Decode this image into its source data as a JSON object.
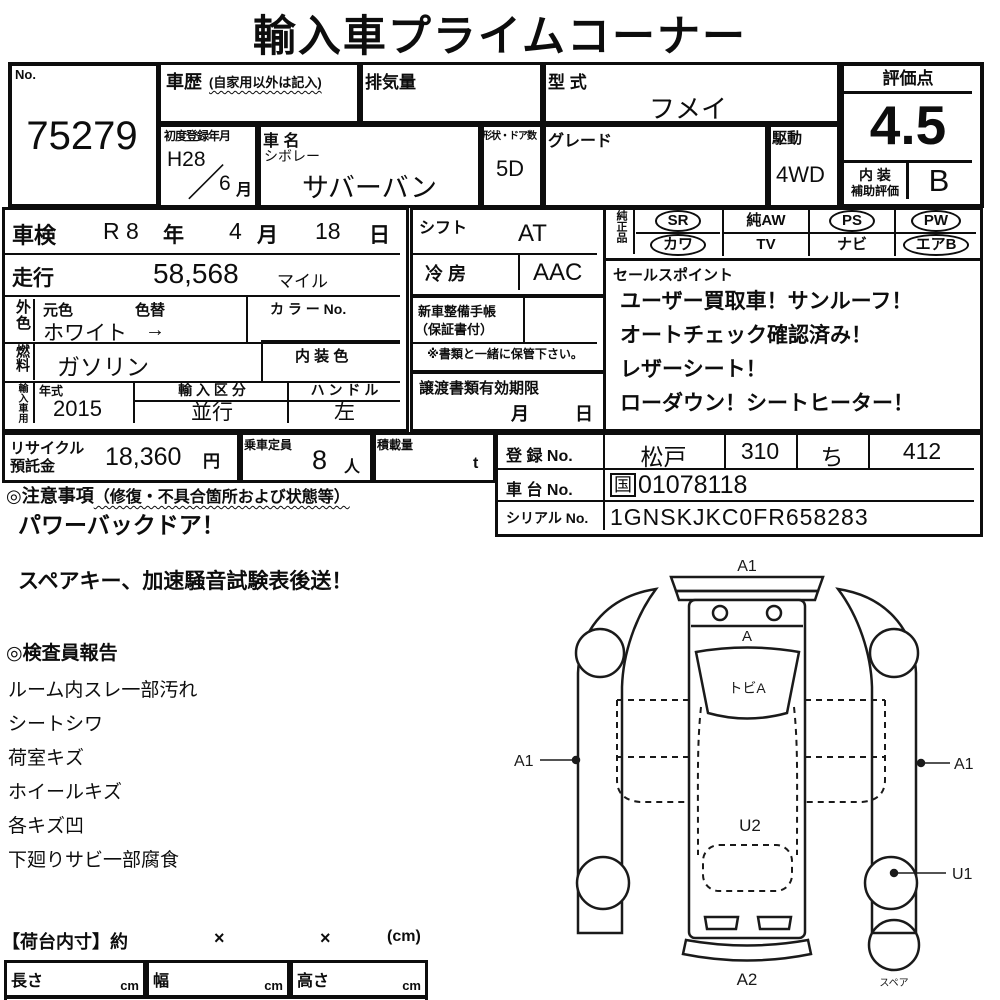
{
  "title": "輸入車プライムコーナー",
  "header": {
    "no": {
      "label": "No.",
      "value": "75279"
    },
    "history": {
      "label": "車歴",
      "note": "(自家用以外は記入)"
    },
    "displacement": {
      "label": "排気量"
    },
    "model_code": {
      "label": "型 式",
      "value": "フメイ"
    },
    "first_reg": {
      "label": "初度登録年月",
      "year": "H28",
      "slash": "／",
      "month": "6",
      "month_unit": "月"
    },
    "car_name": {
      "label": "車 名",
      "maker": "シボレー",
      "model": "サバーバン"
    },
    "doors": {
      "label": "形状・ドア数",
      "value": "5D"
    },
    "grade": {
      "label": "グレード",
      "value": ""
    },
    "drive": {
      "label": "駆動",
      "value": "4WD"
    }
  },
  "score": {
    "label": "評価点",
    "value": "4.5",
    "interior_label1": "内 装",
    "interior_label2": "補助評価",
    "interior_value": "B"
  },
  "main": {
    "shaken": {
      "label": "車検",
      "era": "R 8",
      "era_unit": "年",
      "month": "4",
      "month_unit": "月",
      "day": "18",
      "day_unit": "日"
    },
    "mileage": {
      "label": "走行",
      "value": "58,568",
      "unit": "マイル"
    },
    "exterior": {
      "side_label": "外色",
      "orig_label": "元色",
      "change_label": "色替",
      "value": "ホワイト",
      "arrow": "→",
      "color_no_label": "カ ラ ー No."
    },
    "fuel": {
      "side_label": "燃料",
      "value": "ガソリン",
      "interior_color_label": "内 装 色"
    },
    "import_info": {
      "side_label": "輸入車用",
      "year_label": "年式",
      "year_value": "2015",
      "class_label": "輸 入 区 分",
      "class_value": "並行",
      "handle_label": "ハ ン ド ル",
      "handle_value": "左"
    },
    "shift": {
      "label": "シフト",
      "value": "AT"
    },
    "ac": {
      "label": "冷 房",
      "value": "AAC"
    },
    "service_book": {
      "label1": "新車整備手帳",
      "label2": "（保証書付）"
    },
    "keep_note": "※書類と一緒に保管下さい。",
    "transfer": {
      "label": "譲渡書類有効期限",
      "month_unit": "月",
      "day_unit": "日"
    }
  },
  "equipment": {
    "side_label": "純正品",
    "items": [
      {
        "label": "SR",
        "circled": true
      },
      {
        "label": "純AW",
        "circled": false
      },
      {
        "label": "PS",
        "circled": true
      },
      {
        "label": "PW",
        "circled": true
      },
      {
        "label": "カワ",
        "circled": true
      },
      {
        "label": "TV",
        "circled": false
      },
      {
        "label": "ナビ",
        "circled": false
      },
      {
        "label": "エアB",
        "circled": true
      }
    ]
  },
  "sales_points": {
    "label": "セールスポイント",
    "lines": [
      "ユーザー買取車！サンルーフ！",
      "オートチェック確認済み！",
      "レザーシート！",
      "ローダウン！シートヒーター！"
    ]
  },
  "recycle": {
    "label1": "リサイクル",
    "label2": "預託金",
    "value": "18,360",
    "unit": "円"
  },
  "capacity": {
    "label": "乗車定員",
    "value": "8",
    "unit": "人"
  },
  "load": {
    "label": "積載量",
    "unit": "t"
  },
  "registration": {
    "reg_label": "登 録 No.",
    "area": "松戸",
    "class_no": "310",
    "kana": "ち",
    "number": "412",
    "chassis_label": "車 台 No.",
    "chassis_prefix": "国",
    "chassis_value": "01078118",
    "serial_label": "シリアル No.",
    "serial_value": "1GNSKJKC0FR658283"
  },
  "notes": {
    "label": "◎注意事項",
    "sub": "（修復・不具合箇所および状態等）",
    "line": "パワーバックドア！"
  },
  "shipping_note": "スペアキー、加速騒音試験表後送！",
  "inspector_report": {
    "label": "◎検査員報告",
    "items": [
      "ルーム内スレ一部汚れ",
      "シートシワ",
      "荷室キズ",
      "ホイールキズ",
      "各キズ凹",
      "下廻りサビ一部腐食"
    ]
  },
  "cargo_dims": {
    "title": "【荷台内寸】約",
    "x1": "×",
    "x2": "×",
    "unit": "(cm)",
    "cols": [
      {
        "label": "長さ",
        "unit": "cm"
      },
      {
        "label": "幅",
        "unit": "cm"
      },
      {
        "label": "高さ",
        "unit": "cm"
      }
    ]
  },
  "diagram": {
    "a1_top": "A1",
    "hood": "A",
    "windshield": "トビA",
    "a1_left": "A1",
    "a1_right": "A1",
    "u2": "U2",
    "u1": "U1",
    "a2": "A2",
    "spare": "スペア"
  }
}
